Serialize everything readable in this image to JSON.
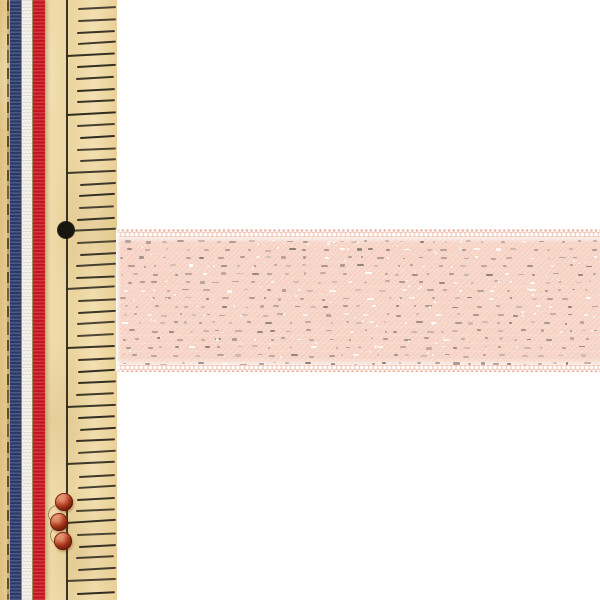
{
  "scene": {
    "type": "product-photo",
    "subject": "pale-pink glitter satin ribbon laid horizontally across a vertical tan sewing ruler that has a blue-white-red striped ribbon along its left edge",
    "background_color": "#ffffff",
    "width": 600,
    "height": 600
  },
  "ruler": {
    "x": 0,
    "width": 117,
    "color": "#eed8a4",
    "edge_line": {
      "x": 7,
      "width": 2,
      "color": "#5d4720"
    },
    "baseline": {
      "x": 66,
      "width": 1.6,
      "color": "#3a3326"
    },
    "ticks": {
      "count": 51,
      "base_y": -3.4,
      "spacing": 11.68,
      "per_major": 5,
      "minor_left": 78,
      "major_left": 66,
      "right": 115.5,
      "thickness": 2,
      "tilt_deg": -3,
      "color": "#2e2a1f"
    },
    "hole": {
      "cx": 66,
      "cy": 230,
      "r": 8,
      "color": "#17150f"
    },
    "beads": {
      "color_outer": "#6f1c0b",
      "color_mid": "#bf4527",
      "color_highlight": "#d98a6a",
      "loop_color": "rgba(110,85,45,0.55)",
      "items": [
        {
          "cx": 64,
          "cy": 502,
          "r": 9
        },
        {
          "cx": 58.5,
          "cy": 522,
          "r": 9
        },
        {
          "cx": 62.5,
          "cy": 540.5,
          "r": 9
        }
      ],
      "loops": [
        {
          "cx": 56,
          "cy": 513,
          "r": 8.5
        },
        {
          "cx": 58,
          "cy": 534,
          "r": 8.5
        }
      ]
    }
  },
  "tricolor_ribbon": {
    "x": 9.5,
    "width": 35.5,
    "gap": 0.8,
    "gap_color": "rgba(96,74,40,0.55)",
    "stripes": [
      {
        "name": "blue",
        "color": "#2c3a69",
        "width": 11.4
      },
      {
        "name": "white",
        "color": "#f7f4ec",
        "width": 10.8
      },
      {
        "name": "red",
        "color": "#c9141f",
        "width": 11.6
      }
    ]
  },
  "pink_ribbon": {
    "x": 116,
    "top": 229,
    "width": 484,
    "height": 143,
    "base_color": "#f7d4c6",
    "edge_band_color": "#f3c9ba",
    "picot_dot_color": "#ffffff",
    "picot_tip_color": "#eeb09e",
    "layout": {
      "tips_h": 3,
      "picot_h": 4.5,
      "body_top": 7.5,
      "body_height": 128.5
    },
    "sparkle": {
      "rows": 16,
      "first_row_y": 4,
      "row_spacing": 8.15,
      "colors": [
        "#8d7d78",
        "#ab9891",
        "#c5b5ae",
        "#ffffff"
      ],
      "speck_color": "rgba(255,255,255,0.85)",
      "speck_count": 130
    }
  }
}
